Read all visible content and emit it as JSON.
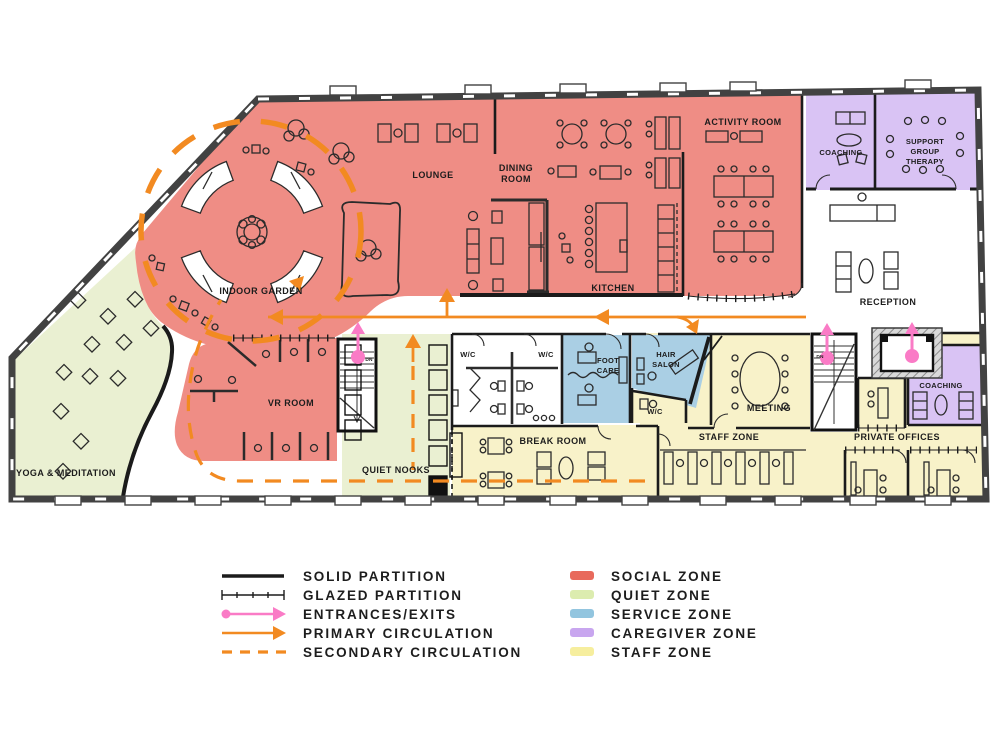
{
  "plan": {
    "rooms": {
      "indoor_garden": {
        "label": [
          "INDOOR GARDEN"
        ],
        "zone": "social"
      },
      "lounge": {
        "label": [
          "LOUNGE"
        ],
        "zone": "social"
      },
      "dining_room": {
        "label": [
          "DINING",
          "ROOM"
        ],
        "zone": "social"
      },
      "kitchen": {
        "label": [
          "KITCHEN"
        ],
        "zone": "social"
      },
      "activity_room": {
        "label": [
          "ACTIVITY ROOM"
        ],
        "zone": "social"
      },
      "vr_room": {
        "label": [
          "VR ROOM"
        ],
        "zone": "social"
      },
      "coaching_upper": {
        "label": [
          "COACHING"
        ],
        "zone": "caregiver"
      },
      "support_group_therapy": {
        "label": [
          "SUPPORT",
          "GROUP",
          "THERAPY"
        ],
        "zone": "caregiver"
      },
      "coaching_lower": {
        "label": [
          "COACHING"
        ],
        "zone": "caregiver"
      },
      "reception": {
        "label": [
          "RECEPTION"
        ],
        "zone": "none"
      },
      "yoga_meditation": {
        "label": [
          "YOGA & MEDITATION"
        ],
        "zone": "quiet"
      },
      "quiet_nooks": {
        "label": [
          "QUIET NOOKS"
        ],
        "zone": "quiet"
      },
      "wc_west": {
        "label": [
          "W/C"
        ],
        "zone": "none"
      },
      "wc_east": {
        "label": [
          "W/C"
        ],
        "zone": "none"
      },
      "wc_staff": {
        "label": [
          "W/C"
        ],
        "zone": "staff"
      },
      "foot_care": {
        "label": [
          "FOOT",
          "CARE"
        ],
        "zone": "service"
      },
      "hair_salon": {
        "label": [
          "HAIR",
          "SALON"
        ],
        "zone": "service"
      },
      "break_room": {
        "label": [
          "BREAK ROOM"
        ],
        "zone": "staff"
      },
      "meeting": {
        "label": [
          "MEETING"
        ],
        "zone": "staff"
      },
      "staff_zone": {
        "label": [
          "STAFF ZONE"
        ],
        "zone": "staff"
      },
      "private_offices": {
        "label": [
          "PRIVATE OFFICES"
        ],
        "zone": "staff"
      },
      "stair_west": {
        "label": [
          "DN"
        ]
      },
      "stair_east": {
        "label": [
          "DN"
        ]
      }
    },
    "zone_fills": {
      "social": "#EF8D85",
      "quiet": "#EAF0D2",
      "service": "#AACFE4",
      "caregiver": "#D9C3F4",
      "staff": "#F8F2C9"
    },
    "accents": {
      "circulation_orange": "#F28A21",
      "entrance_pink": "#FA7BC6",
      "wall_dark": "#424242",
      "line_black": "#1B1B1B"
    }
  },
  "legend": {
    "symbols": [
      {
        "id": "solid-partition",
        "label": "SOLID PARTITION",
        "type": "solid-line",
        "color": "#1B1B1B"
      },
      {
        "id": "glazed-partition",
        "label": "GLAZED PARTITION",
        "type": "ticked-line",
        "color": "#1B1B1B"
      },
      {
        "id": "entrances-exits",
        "label": "ENTRANCES/EXITS",
        "type": "dot-arrow",
        "color": "#FA7BC6"
      },
      {
        "id": "primary-circulation",
        "label": "PRIMARY CIRCULATION",
        "type": "arrow",
        "color": "#F28A21"
      },
      {
        "id": "secondary-circulation",
        "label": "SECONDARY CIRCULATION",
        "type": "dashed-line",
        "color": "#F28A21"
      }
    ],
    "zones": [
      {
        "id": "social-zone",
        "label": "SOCIAL ZONE",
        "color": "#E86A5C"
      },
      {
        "id": "quiet-zone",
        "label": "QUIET ZONE",
        "color": "#DCECAF"
      },
      {
        "id": "service-zone",
        "label": "SERVICE ZONE",
        "color": "#92C5DF"
      },
      {
        "id": "caregiver-zone",
        "label": "CAREGIVER ZONE",
        "color": "#C8A6EF"
      },
      {
        "id": "staff-zone",
        "label": "STAFF ZONE",
        "color": "#F6EE9E"
      }
    ]
  }
}
